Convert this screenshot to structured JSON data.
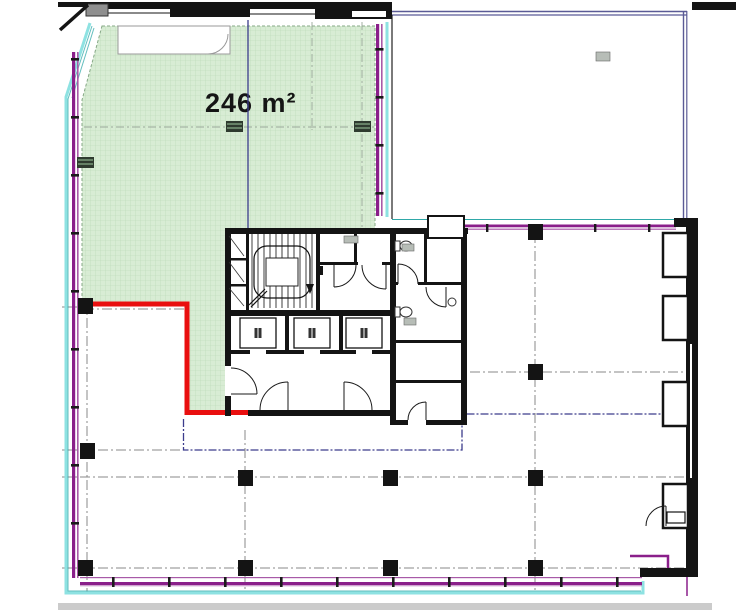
{
  "page": {
    "type": "architectural-floor-plan",
    "description": "office floor plan with highlighted lettable unit"
  },
  "highlighted_unit": {
    "area_label": "246 m²"
  },
  "colors": {
    "highlight_fill": "#d8ecd4",
    "highlight_grid": "#b9d9b4",
    "boundary_red": "#e90f0f",
    "window_purple": "#8a1f8a",
    "window_purple_light": "#a85aa8",
    "facade_cyan": "#8ee2e2",
    "facade_teal": "#2fa8a8",
    "wall_black": "#141414",
    "lease_navy": "#3c3c8c",
    "grid_gray": "#8a8a8a",
    "unit_border_navy": "#5b5b96",
    "label_ink": "#151515",
    "bottom_strip_gray": "#cbcbcb"
  }
}
